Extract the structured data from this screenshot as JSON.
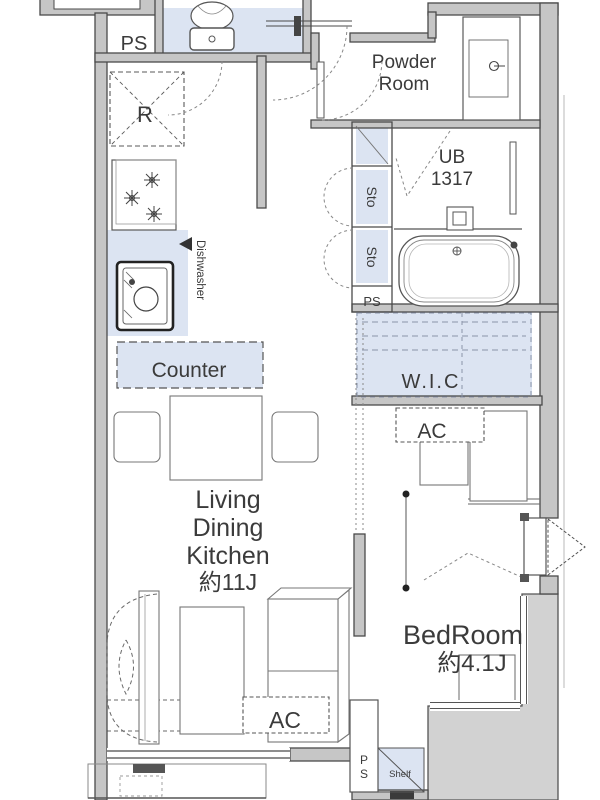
{
  "plan": {
    "type": "apartment-floor-plan",
    "rooms": {
      "powder_room": {
        "line1": "Powder",
        "line2": "Room"
      },
      "unit_bath": {
        "line1": "UB",
        "line2": "1317"
      },
      "living": {
        "line1": "Living",
        "line2": "Dining",
        "line3": "Kitchen",
        "size": "約11J"
      },
      "bedroom": {
        "name": "BedRoom",
        "size": "約4.1J"
      },
      "wic": {
        "label": "W.I.C"
      }
    },
    "labels": {
      "ps_top": "PS",
      "refrigerator": "R",
      "sto_upper": "Sto",
      "sto_lower": "Sto",
      "ps_middle": "PS",
      "dishwasher": "Dishwasher",
      "counter": "Counter",
      "ac_bedroom": "AC",
      "ac_living": "AC",
      "shelf": "Shelf",
      "ps_bottom_p": "P",
      "ps_bottom_s": "S"
    },
    "colors": {
      "floor_accent": "#dce4f2",
      "wall_fill": "#c6c6c6",
      "balcony_fill": "#d2d2d2",
      "line": "#4a4a4a",
      "text": "#3b3b3b"
    }
  }
}
